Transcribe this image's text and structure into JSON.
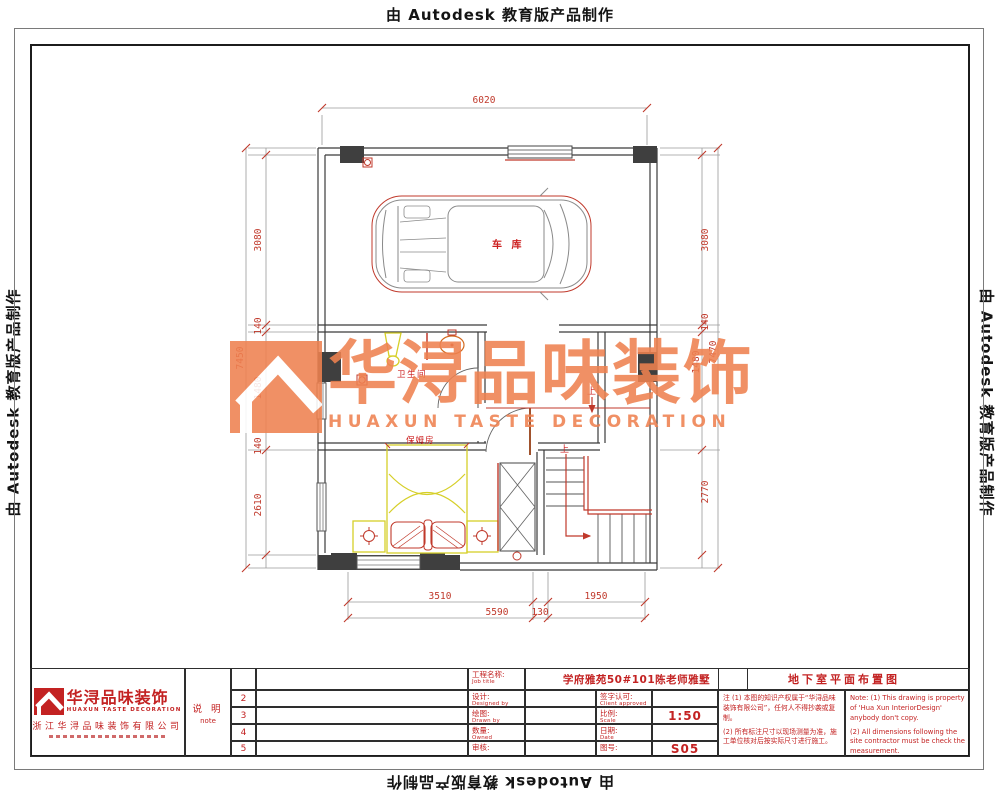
{
  "banner": {
    "autodesk": "由 Autodesk 教育版产品制作"
  },
  "watermark": {
    "cn": "华浔品味装饰",
    "en": "HUAXUN TASTE DECORATION"
  },
  "plan": {
    "labels": {
      "garage": "车 库",
      "bathroom": "卫生间",
      "maid_room": "保姆房",
      "up1": "上",
      "up2": "上"
    },
    "dims": {
      "top": "6020",
      "left": [
        "3080",
        "140",
        "1480",
        "140",
        "2610"
      ],
      "left_total": "7450",
      "right": [
        "3080",
        "140",
        "1480",
        "2770"
      ],
      "right_total": "7470",
      "bottom_row1": [
        "3510",
        "1950"
      ],
      "bottom_row2": [
        "5590",
        "130"
      ]
    }
  },
  "titleblock": {
    "logo_cn": "华浔品味装饰",
    "logo_en": "HUAXUN TASTE DECORATION",
    "company": "浙江华浔品味装饰有限公司",
    "note_cn": "说 明",
    "note_en": "note",
    "rows": [
      "2",
      "3",
      "4",
      "5"
    ],
    "job_label_cn": "工程名称:",
    "job_label_en": "Job title",
    "job_value": "学府雅苑50#101陈老师雅墅",
    "design_cn": "设计:",
    "design_en": "Designed by",
    "draw_cn": "绘图:",
    "draw_en": "Drawn by",
    "qty_cn": "数量:",
    "qty_en": "Owned",
    "check_cn": "审核:",
    "client_cn": "签字认可:",
    "client_en": "Client approved",
    "scale_cn": "比例:",
    "scale_en": "Scale",
    "scale_value": "1:50",
    "date_cn": "日期:",
    "date_en": "Date",
    "sheet_cn": "图号:",
    "sheet_value": "S05",
    "drawing_title": "地下室平面布置图",
    "note1_cn": "注 (1) 本图的知识产权属于“华浔品味装饰有限公司”，任何人不得抄袭或复制。",
    "note2_cn": "(2) 所有标注尺寸以现场测量为准，施工单位核对后按实际尺寸进行施工。",
    "note1_en": "Note: (1) This drawing is property of 'Hua Xun InteriorDesign' anybody don't copy.",
    "note2_en": "(2) All dimensions following the site contractor must be check the measurement."
  },
  "colors": {
    "watermark_orange": "#ef8150",
    "titleblock_red": "#c32222",
    "dim_red": "#c0392b",
    "furniture_yellow": "#d6cf28",
    "wall_dark": "#3b3b3b"
  }
}
